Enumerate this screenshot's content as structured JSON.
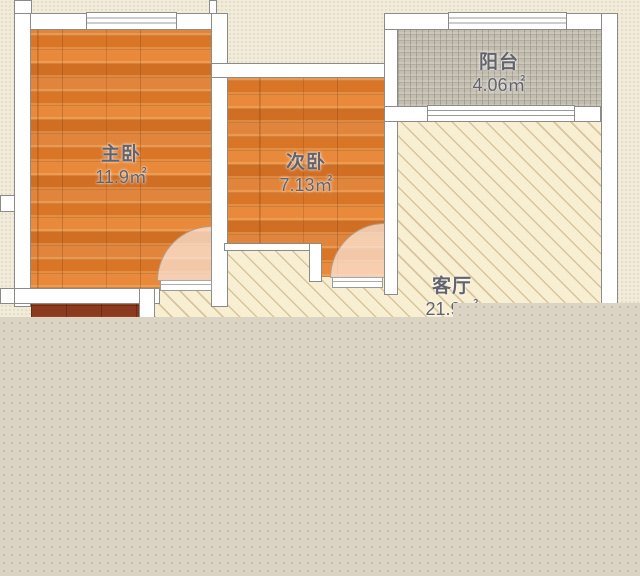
{
  "plan": {
    "rooms": [
      {
        "id": "master-bedroom",
        "name": "主卧",
        "area": "11.9㎡"
      },
      {
        "id": "second-bedroom",
        "name": "次卧",
        "area": "7.13㎡"
      },
      {
        "id": "balcony",
        "name": "阳台",
        "area": "4.06㎡"
      },
      {
        "id": "living-room",
        "name": "客厅",
        "area": "21.9㎡"
      }
    ],
    "colors": {
      "background": "#F1EBD9",
      "wood_floor": "#DF7E2E",
      "kitchen_floor": "#8C3A1E",
      "balcony_tile": "#C3BDAF",
      "living_floor": "#F8EFD2",
      "wall_fill": "#FFFFFF",
      "wall_outline": "#8B8B89",
      "label_text": "#63636B",
      "overlay": "#DBD4C5"
    }
  }
}
